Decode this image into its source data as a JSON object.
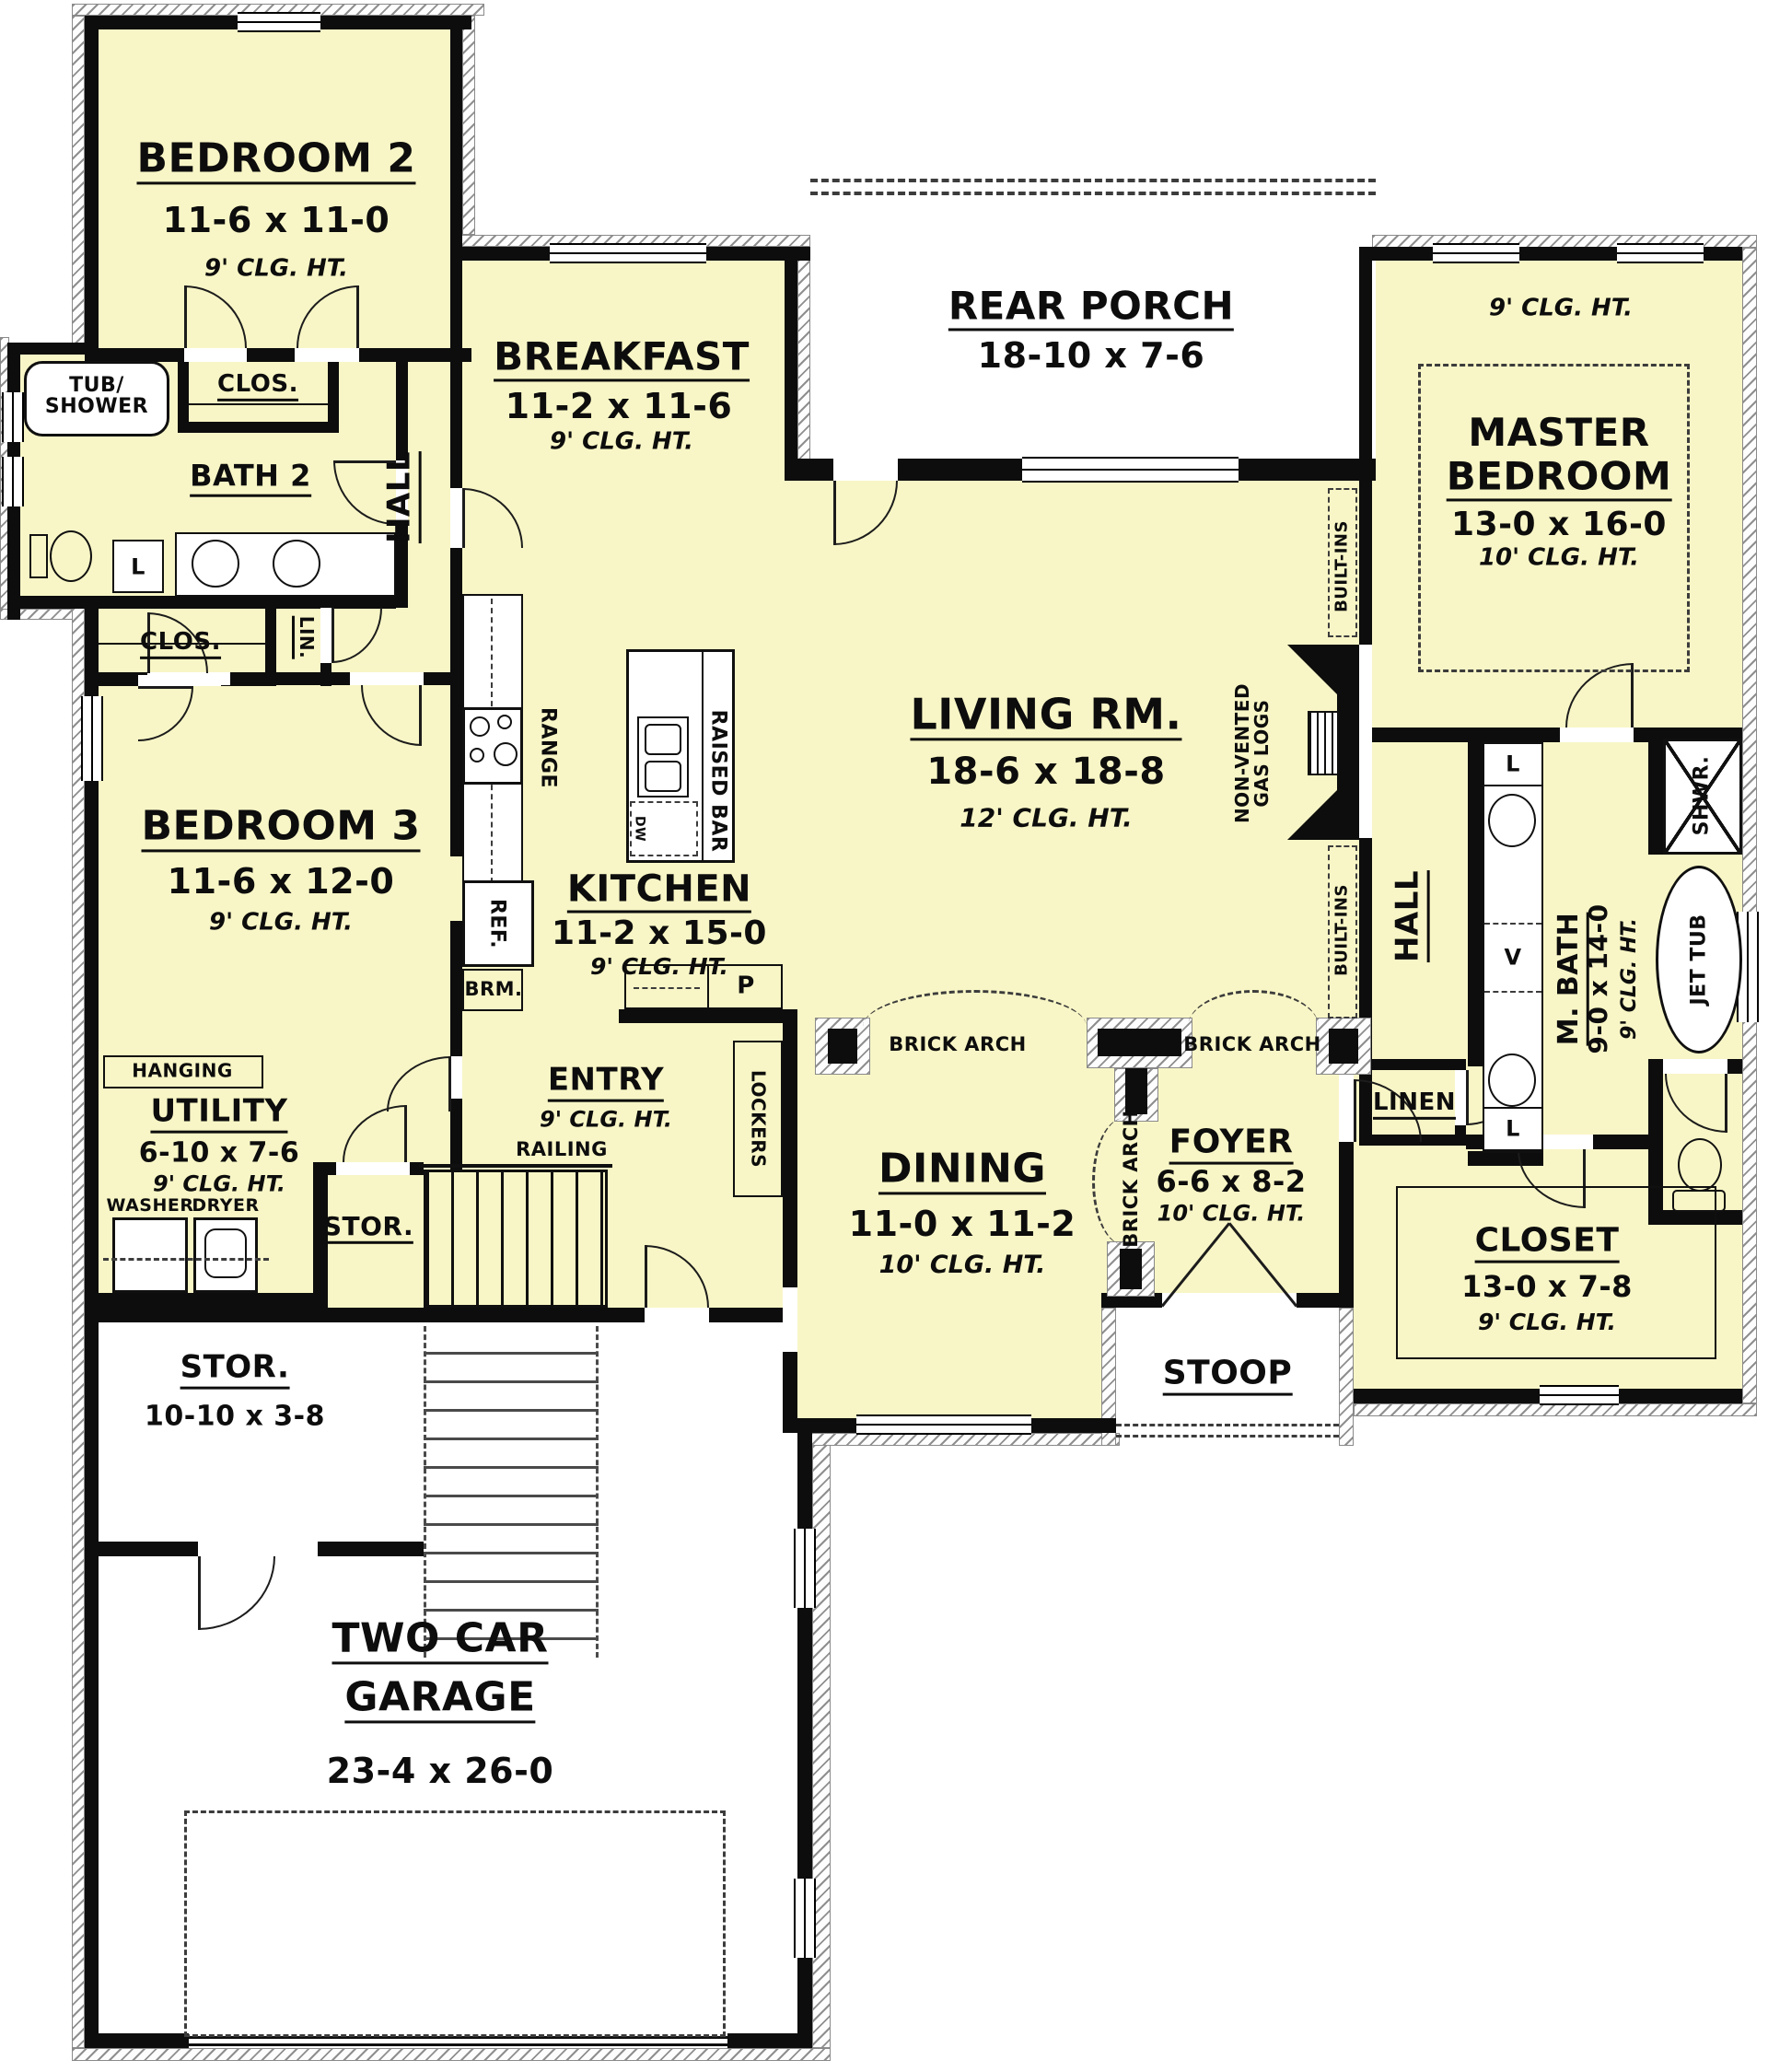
{
  "colors": {
    "floor": "#f8f6c6",
    "wall": "#0d0d0d",
    "exterior": "#ffffff"
  },
  "rooms": {
    "bedroom2": {
      "name": "BEDROOM 2",
      "dims": "11-6 x 11-0",
      "clg": "9' CLG. HT."
    },
    "bath2": {
      "name": "BATH 2"
    },
    "bedroom3": {
      "name": "BEDROOM 3",
      "dims": "11-6 x 12-0",
      "clg": "9' CLG. HT."
    },
    "breakfast": {
      "name": "BREAKFAST",
      "dims": "11-2 x 11-6",
      "clg": "9' CLG. HT."
    },
    "rear_porch": {
      "name": "REAR PORCH",
      "dims": "18-10 x 7-6"
    },
    "master": {
      "name1": "MASTER",
      "name2": "BEDROOM",
      "dims": "13-0 x 16-0",
      "clg": "10' CLG. HT.",
      "clg_outer": "9' CLG. HT."
    },
    "living": {
      "name": "LIVING RM.",
      "dims": "18-6 x 18-8",
      "clg": "12' CLG. HT."
    },
    "kitchen": {
      "name": "KITCHEN",
      "dims": "11-2 x 15-0",
      "clg": "9' CLG. HT."
    },
    "utility": {
      "name": "UTILITY",
      "dims": "6-10 x 7-6",
      "clg": "9' CLG. HT."
    },
    "entry": {
      "name": "ENTRY",
      "clg": "9' CLG. HT."
    },
    "dining": {
      "name": "DINING",
      "dims": "11-0 x 11-2",
      "clg": "10' CLG. HT."
    },
    "foyer": {
      "name": "FOYER",
      "dims": "6-6 x 8-2",
      "clg": "10' CLG. HT."
    },
    "mbath": {
      "name": "M. BATH",
      "dims": "9-0 x 14-0",
      "clg": "9' CLG. HT."
    },
    "closet": {
      "name": "CLOSET",
      "dims": "13-0 x 7-8",
      "clg": "9' CLG. HT."
    },
    "stoop": {
      "name": "STOOP"
    },
    "stor_upper": {
      "name": "STOR."
    },
    "stor_lower": {
      "name": "STOR.",
      "dims": "10-10 x 3-8"
    },
    "garage": {
      "name1": "TWO CAR",
      "name2": "GARAGE",
      "dims": "23-4 x 26-0"
    },
    "hall": {
      "name": "HALL"
    }
  },
  "labels": {
    "tub1": "TUB/",
    "tub2": "SHOWER",
    "clos": "CLOS.",
    "lin": "LIN.",
    "linen": "LINEN",
    "hanging": "HANGING",
    "washer": "WASHER",
    "dryer": "DRYER",
    "railing": "RAILING",
    "lockers": "LOCKERS",
    "range": "RANGE",
    "raised_bar": "RAISED BAR",
    "dw": "DW",
    "ref": "REF.",
    "brm": "BRM.",
    "p": "P",
    "l": "L",
    "v": "V",
    "shwr": "SHWR.",
    "jet_tub": "JET TUB",
    "brick_arch": "BRICK ARCH",
    "built_ins": "BUILT-INS",
    "gas1": "NON-VENTED",
    "gas2": "GAS LOGS"
  }
}
